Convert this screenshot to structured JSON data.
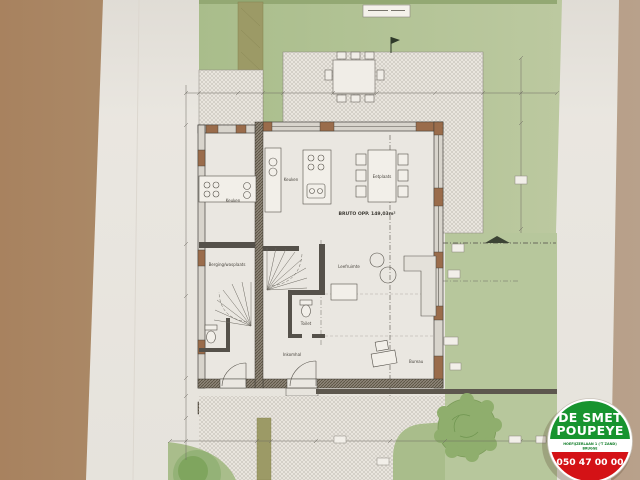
{
  "plan": {
    "bruto_label": "BRUTO OPP. 149,03m²",
    "rooms": {
      "keuken_neighbor": "Keuken",
      "keuken": "Keuken",
      "eetplaats": "Eetplaats",
      "leefruimte": "Leefruimte",
      "toilet": "Toilet",
      "berging": "Berging/wasplaats",
      "inkomhal": "Inkomhal",
      "bureau": "Bureau"
    }
  },
  "logo": {
    "name_line1": "DE SMET",
    "name_line2": "POUPEYE",
    "address": "HOEFIJZERLAAN 1 ('T ZAND)",
    "city": "BRUGGE",
    "phone": "050 47 00 00"
  },
  "colors": {
    "background_tan": "#a98a6a",
    "paper_white": "#ece9e3",
    "grass_green": "#aec18f",
    "hedge_olive": "#9c9a66",
    "tree_green": "#7fa55e",
    "masonry_brown": "#9a6c4b",
    "logo_green": "#17942f",
    "logo_red": "#d41216"
  }
}
